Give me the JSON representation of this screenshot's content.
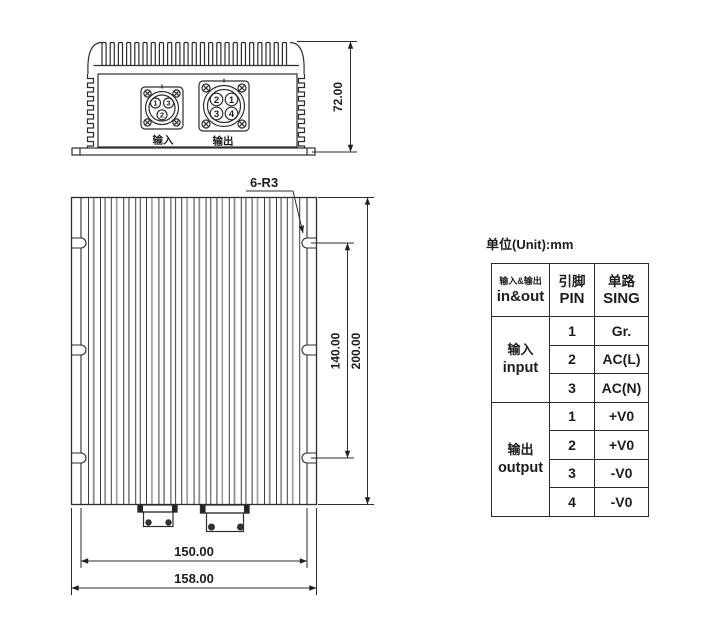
{
  "drawing": {
    "front_view": {
      "input_label": "输入",
      "output_label": "输出",
      "input_pins": [
        "1",
        "3",
        "2"
      ],
      "output_pins": [
        "2",
        "1",
        "3",
        "4"
      ],
      "height_dim": "72.00"
    },
    "top_view": {
      "notch_callout": "6-R3",
      "mount_hole_spacing_dim": "140.00",
      "overall_length_dim": "200.00",
      "mount_width_dim": "150.00",
      "overall_width_dim": "158.00"
    }
  },
  "table": {
    "unit_note": "单位(Unit):mm",
    "header": {
      "inout_zh": "输入&输出",
      "inout_en": "in&out",
      "pin_zh": "引脚",
      "pin_en": "PIN",
      "sing_zh": "单路",
      "sing_en": "SING"
    },
    "groups": [
      {
        "label_zh": "输入",
        "label_en": "input",
        "rows": [
          {
            "pin": "1",
            "sing": "Gr."
          },
          {
            "pin": "2",
            "sing": "AC(L)"
          },
          {
            "pin": "3",
            "sing": "AC(N)"
          }
        ]
      },
      {
        "label_zh": "输出",
        "label_en": "output",
        "rows": [
          {
            "pin": "1",
            "sing": "+V0"
          },
          {
            "pin": "2",
            "sing": "+V0"
          },
          {
            "pin": "3",
            "sing": "-V0"
          },
          {
            "pin": "4",
            "sing": "-V0"
          }
        ]
      }
    ]
  }
}
